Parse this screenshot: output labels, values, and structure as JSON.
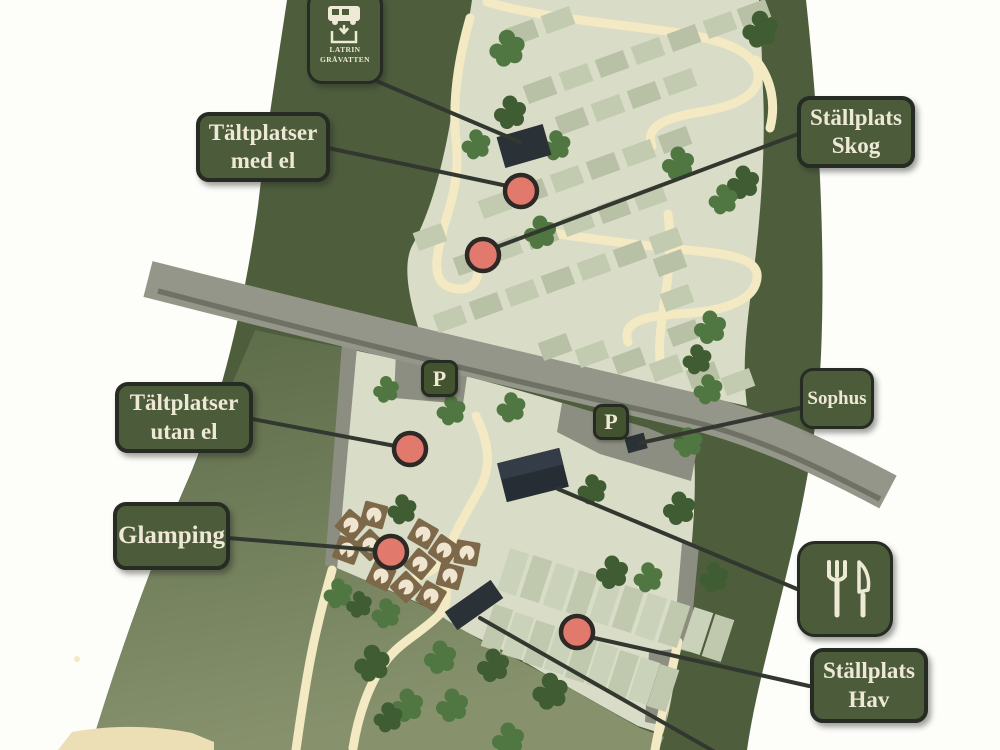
{
  "map_title": "Campsite area map",
  "callouts": {
    "med_el": {
      "line1": "Tältplatser",
      "line2": "med el"
    },
    "skog": {
      "line1": "Ställplats",
      "line2": "Skog"
    },
    "utan_el": {
      "line1": "Tältplatser",
      "line2": "utan el"
    },
    "glamping": {
      "text": "Glamping"
    },
    "sophus": {
      "text": "Sophus"
    },
    "hav": {
      "line1": "Ställplats",
      "line2": "Hav"
    }
  },
  "icons": {
    "latrin": {
      "name": "rv-greywater-latrine-icon",
      "caption1": "LATRIN",
      "caption2": "GRÅVATTEN"
    },
    "cutlery": {
      "name": "fork-knife-restaurant-icon"
    },
    "parking": {
      "letter": "P"
    }
  },
  "colors": {
    "label_bg": "#4c5b3a",
    "label_border": "#262b24",
    "label_text": "#eee9d6",
    "marker_red": "#e17a6c",
    "land_green": "#4e5e3d",
    "site_light": "#d9dcc7",
    "path_cream": "#f3e9c3",
    "road_gray": "#95968a"
  }
}
